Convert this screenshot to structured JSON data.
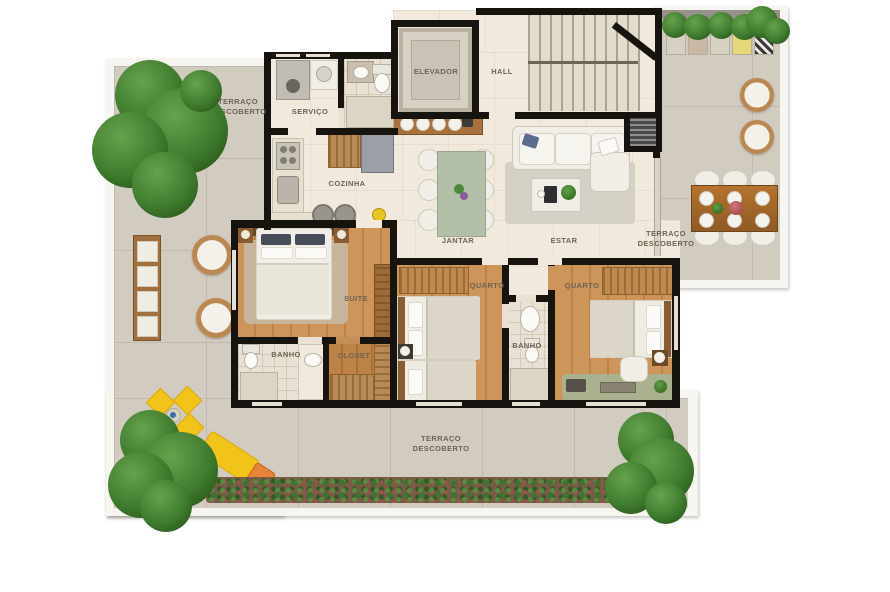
{
  "rooms": {
    "terraco_left": {
      "label": "TERRAÇO DESCOBERTO"
    },
    "terraco_right": {
      "label": "TERRAÇO DESCOBERTO"
    },
    "terraco_bottom": {
      "label": "TERRAÇO DESCOBERTO"
    },
    "servico": {
      "label": "SERVIÇO"
    },
    "elevador": {
      "label": "ELEVADOR"
    },
    "hall": {
      "label": "HALL"
    },
    "cozinha": {
      "label": "COZINHA"
    },
    "jantar": {
      "label": "JANTAR"
    },
    "estar": {
      "label": "ESTAR"
    },
    "suite": {
      "label": "SUITE"
    },
    "banho_suite": {
      "label": "BANHO"
    },
    "closet": {
      "label": "CLOSET"
    },
    "quarto1": {
      "label": "QUARTO"
    },
    "banho2": {
      "label": "BANHO"
    },
    "quarto2": {
      "label": "QUARTO"
    }
  },
  "colors": {
    "wall": "#17130f",
    "terrace_tile": "#d2cbc0",
    "interior_floor": "#f0e9dc",
    "wood_floor": "#c98e52",
    "accent_yellow": "#f2c318",
    "accent_orange": "#e8833a",
    "foliage_green": "#3f7330"
  }
}
